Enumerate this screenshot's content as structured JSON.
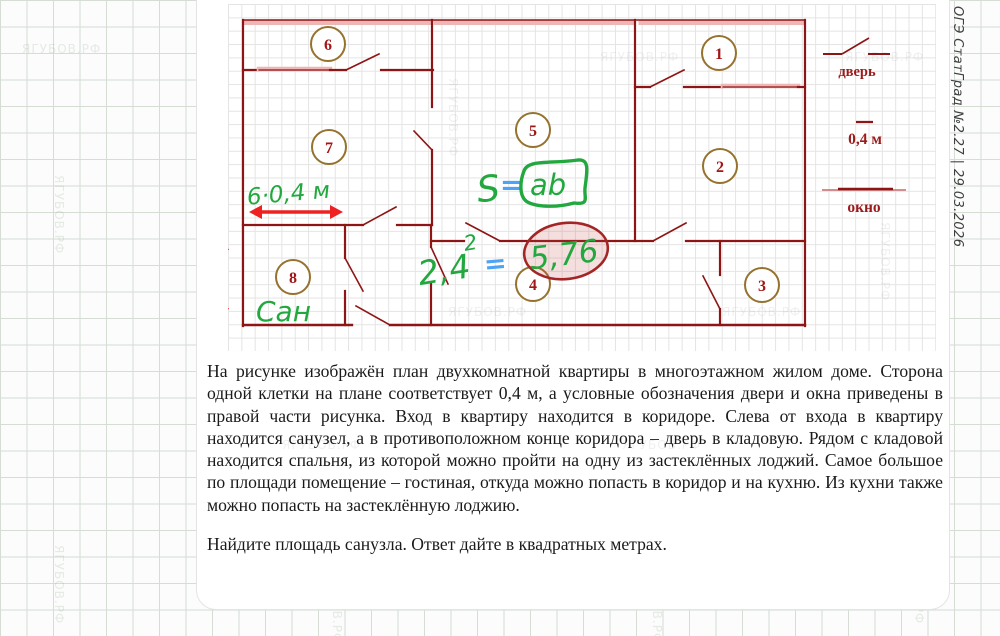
{
  "caption": {
    "text": "ОГЭ СтатГрад №2.27 | 29.03.2026"
  },
  "watermark": {
    "text": "ЯГУБОВ.РФ"
  },
  "plan": {
    "rooms": [
      "1",
      "2",
      "3",
      "4",
      "5",
      "6",
      "7",
      "8"
    ],
    "legend": {
      "door": "дверь",
      "scale": "0,4 м",
      "window": "окно"
    }
  },
  "annotations": {
    "width_label": "6·0,4 м",
    "height_label": "6 · 0,4",
    "san": "Сан",
    "formula": {
      "s": "S",
      "eq": "=",
      "ab": "ab"
    },
    "calc": {
      "base": "2,4",
      "exp": "2",
      "eq": "=",
      "result": "5,76"
    }
  },
  "problem": {
    "paragraph": "На рисунке изображён план двухкомнатной квартиры в многоэтажном жилом доме. Сторона одной клетки на плане соответствует 0,4 м, а условные обозначения двери и окна приведены в правой части рисунка. Вход в квартиру находится в коридоре. Слева от входа в квартиру находится санузел, а в противоположном конце коридора – дверь в кладовую. Рядом с кладовой находится спальня, из которой можно пройти на одну из застеклённых лоджий. Самое большое по площади помещение – гостиная, откуда можно попасть в коридор и на кухню. Из кухни также можно попасть на застеклённую лоджию.",
    "question": "Найдите площадь санузла. Ответ дайте в квадратных метрах."
  },
  "colors": {
    "wall": "#8e1515",
    "window": "#efb6b6",
    "room_circle_stroke": "#96722f",
    "room_number": "#a11616",
    "handwriting_green": "#22a83e",
    "handwriting_blue": "#4da3f5",
    "marker_red": "#ee2020",
    "answer_ellipse_stroke": "#a32525"
  }
}
